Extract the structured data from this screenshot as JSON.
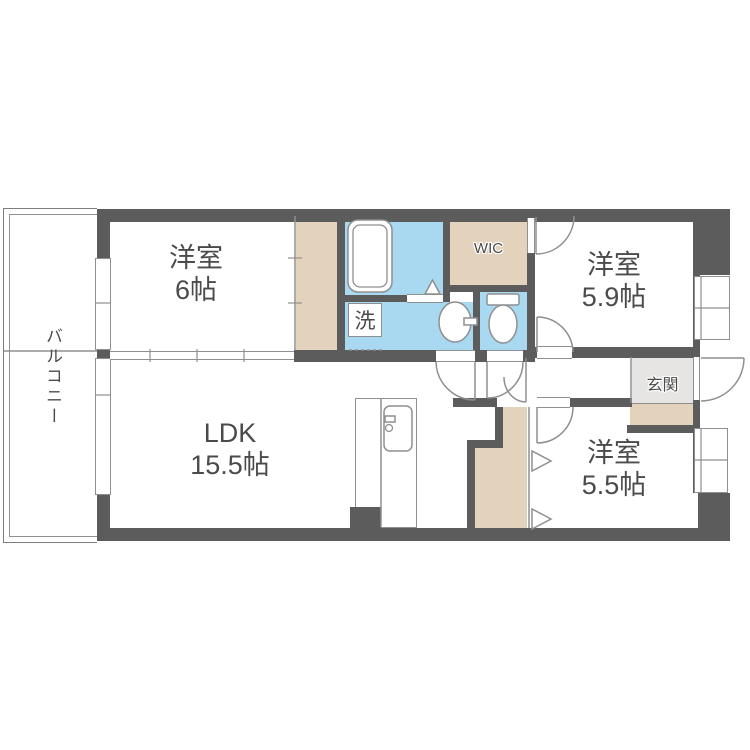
{
  "colors": {
    "wall": "#5c5c5c",
    "wet": "#a9d9f1",
    "closet": "#e4d3bc",
    "genkan": "#e6e5e3",
    "line": "#8f8f8f",
    "balcony_line": "#7d7d7d",
    "text": "#4b4b4b",
    "bg": "#ffffff"
  },
  "rooms": {
    "balcony": {
      "label": "バルコニー"
    },
    "bedroom6": {
      "type": "洋室",
      "size": "6帖"
    },
    "bedroom59": {
      "type": "洋室",
      "size": "5.9帖"
    },
    "bedroom55": {
      "type": "洋室",
      "size": "5.5帖"
    },
    "ldk": {
      "type": "LDK",
      "size": "15.5帖"
    },
    "wic": {
      "label": "WIC"
    },
    "entrance": {
      "label": "玄関"
    },
    "laundry": {
      "label": "洗"
    }
  }
}
